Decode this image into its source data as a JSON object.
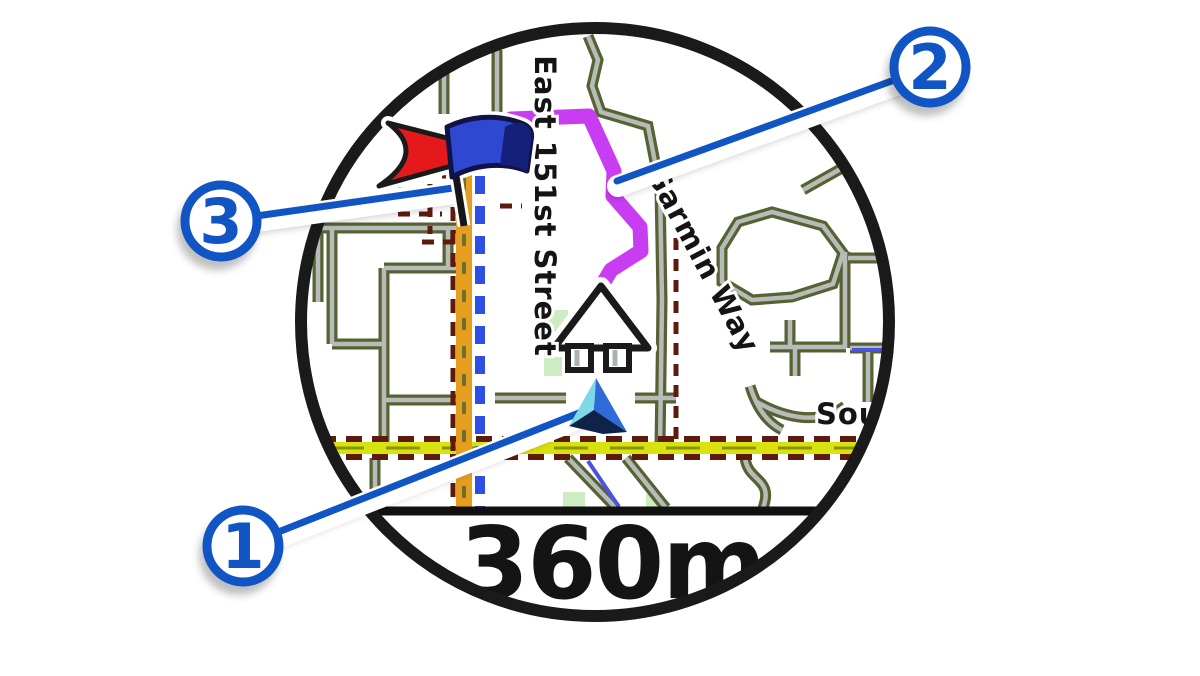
{
  "figure": {
    "description": "Round watch screen showing map navigation with numbered callouts",
    "scale_label": "360m"
  },
  "map": {
    "street_labels": [
      {
        "name": "East 151st Street"
      },
      {
        "name": "Garmin Way"
      },
      {
        "name": "Sout"
      }
    ]
  },
  "callouts": [
    {
      "number": "1",
      "target": "current-position-triangle"
    },
    {
      "number": "2",
      "target": "route-line"
    },
    {
      "number": "3",
      "target": "destination-flag"
    }
  ],
  "colors": {
    "callout_blue": "#1155c4",
    "route_purple": "#c93df2",
    "road_orange": "#e69e1e",
    "road_yellow": "#d8e20e",
    "street_outline_olive": "#586134",
    "street_fill_gray": "#b6bcb8",
    "trail_maroon": "#5e1b0d",
    "track_blue": "#2e4fe4",
    "park_green": "#cdecc2",
    "destination_red": "#e5191b",
    "flag_blue": "#2f48d2",
    "position_cyan": "#7fd8e8",
    "position_blue": "#2e6ad8",
    "position_navy": "#0e2347",
    "bezel_black": "#1a1a1a",
    "turn_arrow_white": "#ffffff"
  }
}
